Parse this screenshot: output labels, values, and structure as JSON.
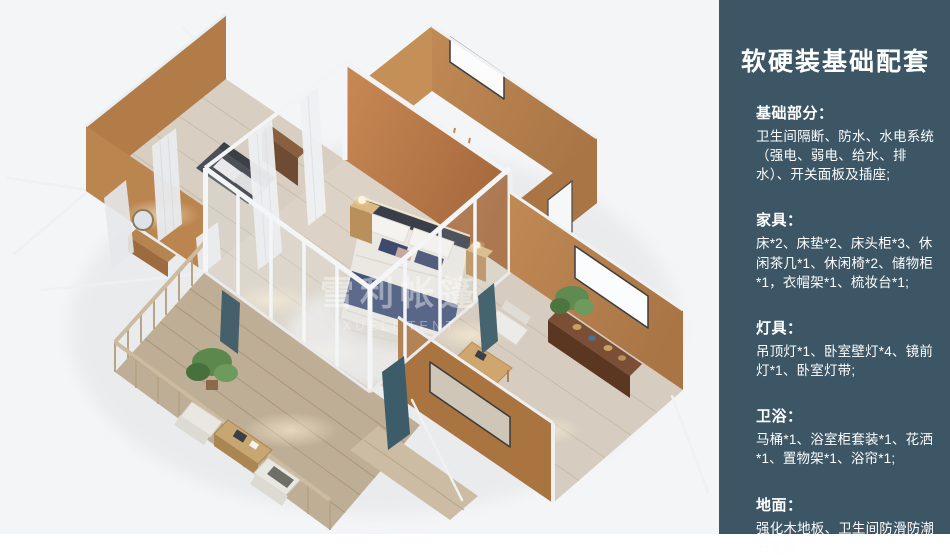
{
  "render": {
    "watermark": {
      "cn": "雪利帐篷",
      "en": "XUELI TENT"
    }
  },
  "sidebar": {
    "title": "软硬装基础配套",
    "sections": [
      {
        "heading": "基础部分：",
        "body": "卫生间隔断、防水、水电系统（强电、弱电、给水、排水）、开关面板及插座;"
      },
      {
        "heading": "家具：",
        "body": "床*2、床垫*2、床头柜*3、休闲茶几*1、休闲椅*2、储物柜*1，衣帽架*1、梳妆台*1;"
      },
      {
        "heading": "灯具：",
        "body": "吊顶灯*1、卧室壁灯*4、镜前灯*1、卧室灯带;"
      },
      {
        "heading": "卫浴：",
        "body": "马桶*1、浴室柜套装*1、花洒*1、置物架*1、浴帘*1;"
      },
      {
        "heading": "地面：",
        "body": "强化木地板、卫生间防滑防潮石塑板;"
      }
    ]
  },
  "colors": {
    "sidebar_bg": "#3c5665",
    "sidebar_text": "#ffffff",
    "canvas_bg": "#f4f5f6",
    "wall_tan": "#b5804d",
    "wall_orange": "#c07c48",
    "floor_wood": "#dcd3c6",
    "deck_wood": "#bfae96",
    "frame_white": "#f4f5f6",
    "bed_navy": "#44537a",
    "curtain_teal": "#3f5c68",
    "plant_green": "#5f8a50"
  }
}
